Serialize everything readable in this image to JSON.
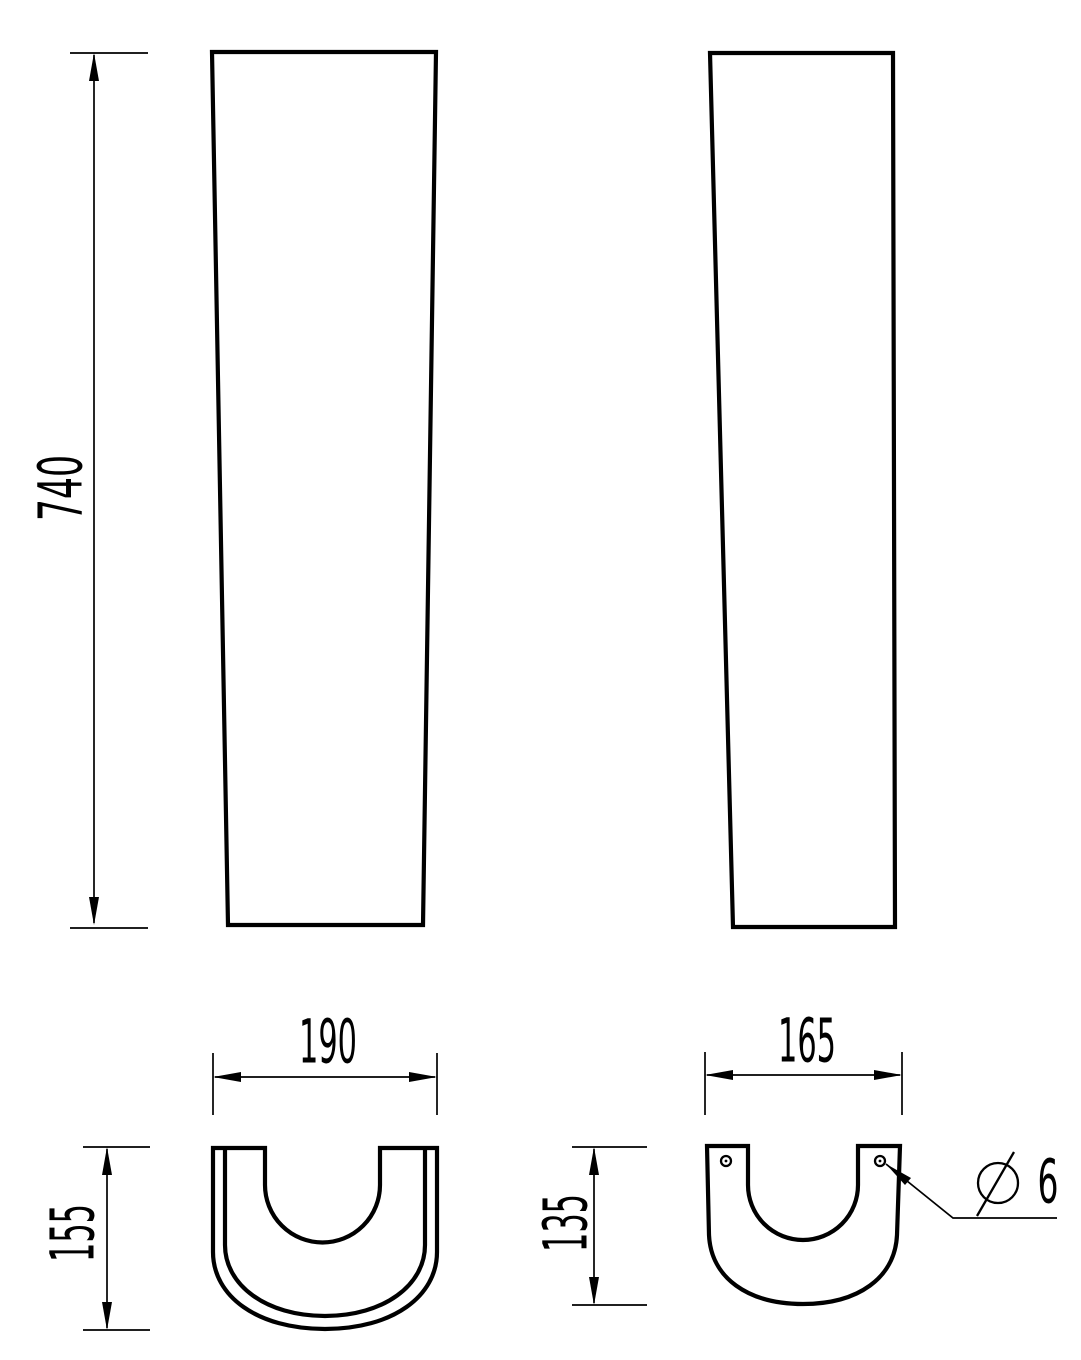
{
  "colors": {
    "background": "#ffffff",
    "line": "#000000"
  },
  "dimensions": {
    "height": "740",
    "front_width": "190",
    "front_depth": "155",
    "side_width": "165",
    "side_depth": "135",
    "diameter_symbol": "⌀",
    "hole_diameter": "6"
  }
}
